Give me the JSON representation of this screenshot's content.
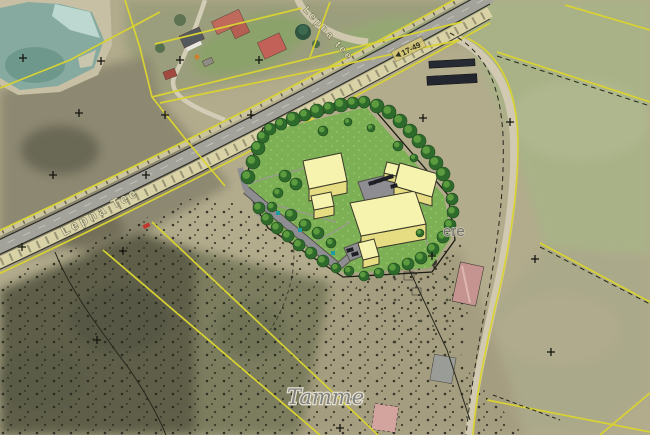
{
  "map": {
    "road_label": "Lepna Tee",
    "road_label_secondary": "Lepna tee",
    "road_marker": "17-49",
    "parcel_label_partial": "ere",
    "place_label": "Tamme",
    "colors": {
      "cadastral_yellow": "#d8d232",
      "lawn_green": "#7daf55",
      "building_roof": "#f6f3ae",
      "building_wall": "#e6dc82",
      "tree_canopy": "#2e6a2b",
      "tree_highlight": "#5d9b3f",
      "pond": "#86aa9f",
      "asphalt": "#a3a39b",
      "label_cream": "#ded8b2"
    }
  }
}
